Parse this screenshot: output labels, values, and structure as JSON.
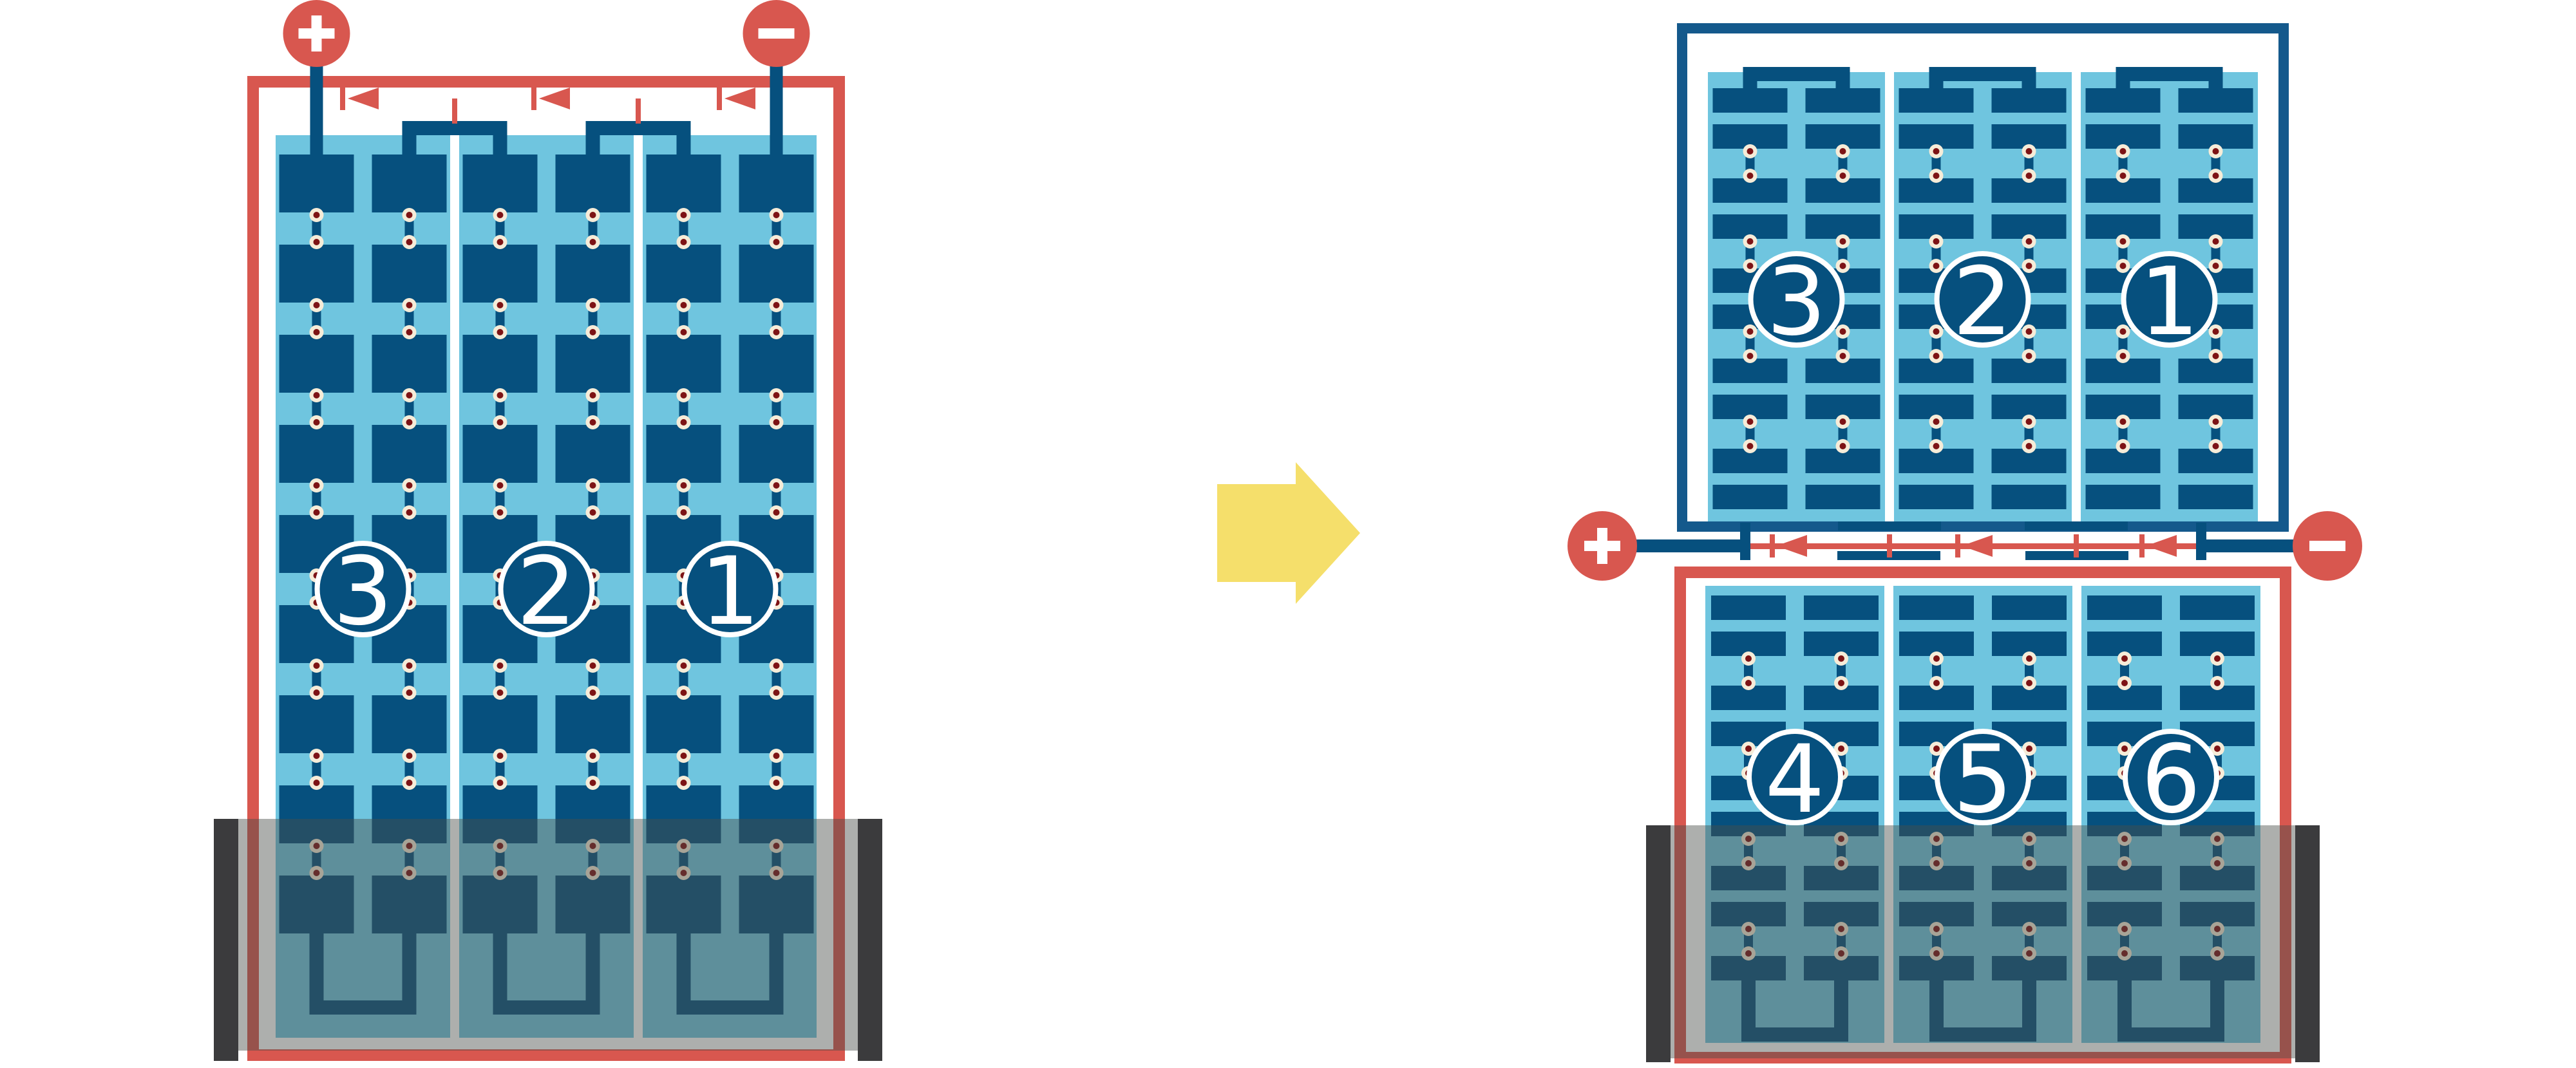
{
  "palette": {
    "red": "#D8574F",
    "cell_navy": "#06507E",
    "frame_navy": "#14598C",
    "light_blue": "#6FC5DF",
    "white": "#FFFFFF",
    "dot_ring": "#F6ECD8",
    "dot_core": "#7D1315",
    "flood_tint": "rgba(74,77,74,0.45)",
    "flood_end_bar": "#3B3B3D",
    "arrow_yellow": "#F5DF6B",
    "number_text": "#FFFFFF"
  },
  "left_module": {
    "panel_labels": [
      "3",
      "2",
      "1"
    ],
    "columns": 3,
    "cell_rows": 9,
    "terminals": {
      "positive": "+",
      "negative": "−"
    },
    "current_arrows": {
      "count": 3,
      "direction": "left"
    },
    "flooded": true
  },
  "transform_arrow": {
    "direction": "right"
  },
  "right_top_module": {
    "panel_labels": [
      "3",
      "2",
      "1"
    ],
    "columns": 3,
    "cell_rows": 5,
    "flooded": false
  },
  "junction": {
    "terminals": {
      "positive": "+",
      "negative": "−"
    },
    "current_arrows": {
      "count": 3,
      "direction": "left"
    }
  },
  "right_bottom_module": {
    "panel_labels": [
      "4",
      "5",
      "6"
    ],
    "columns": 3,
    "cell_rows": 5,
    "flooded": true
  }
}
